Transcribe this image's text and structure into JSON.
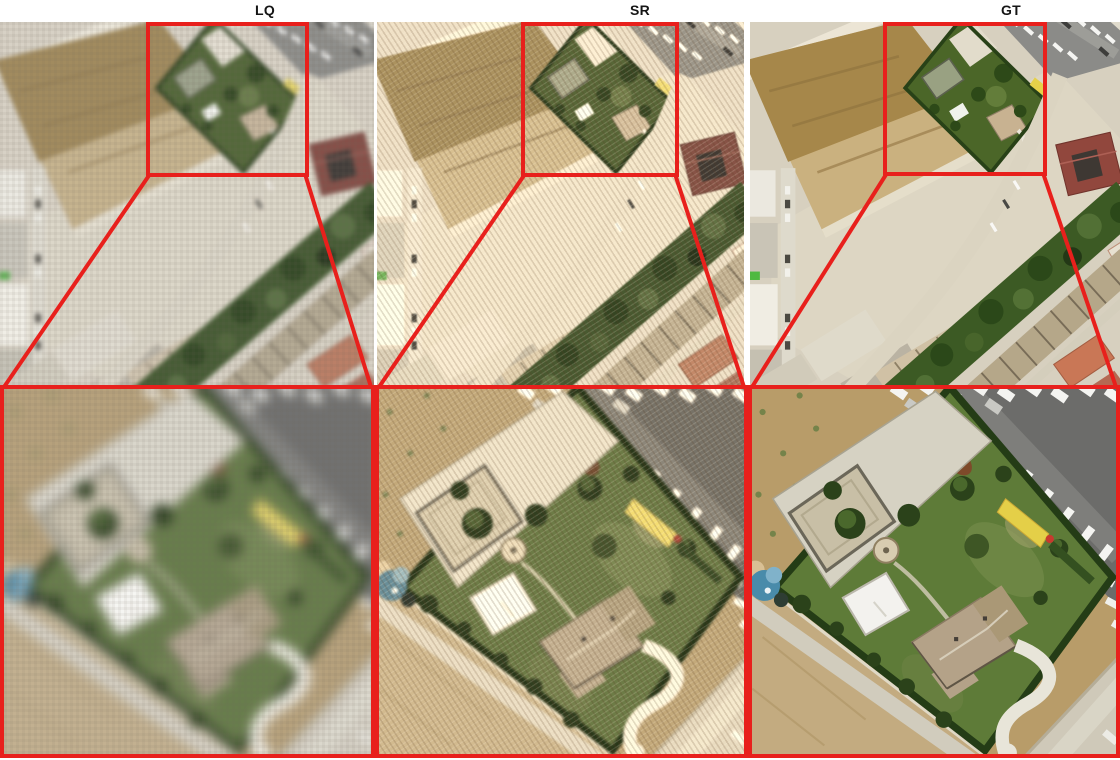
{
  "figure": {
    "columns": [
      {
        "id": "lq",
        "label": "LQ"
      },
      {
        "id": "sr",
        "label": "SR"
      },
      {
        "id": "gt",
        "label": "GT"
      }
    ],
    "highlight_color": "#e8201c"
  }
}
